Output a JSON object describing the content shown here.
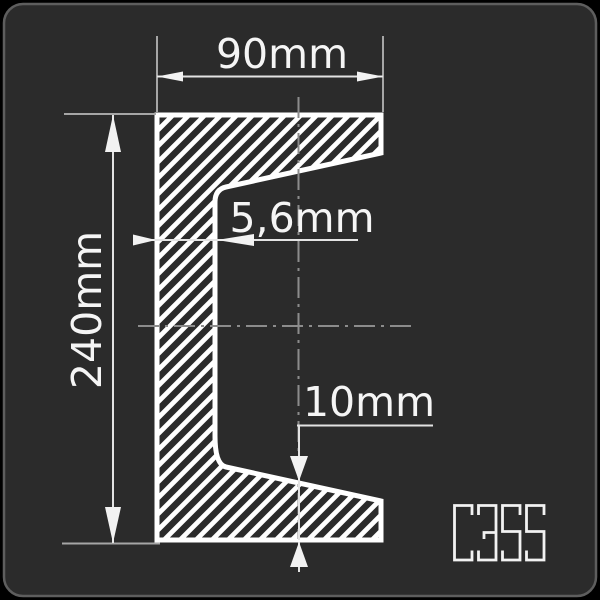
{
  "drawing": {
    "dimensions": {
      "width": {
        "label": "90mm"
      },
      "height": {
        "label": "240mm"
      },
      "web_thickness": {
        "label": "5,6mm"
      },
      "flange_thickness": {
        "label": "10mm"
      }
    },
    "grade": {
      "label": "C355"
    },
    "colors": {
      "panel_background": "#2b2b2b",
      "panel_border": "#5e5e5e",
      "outline": "#ffffff",
      "dimension_line": "#e3e3e3",
      "extension_line": "#a6a6a6",
      "centerline": "#8c8c8c",
      "text": "#f5f5f5"
    }
  }
}
